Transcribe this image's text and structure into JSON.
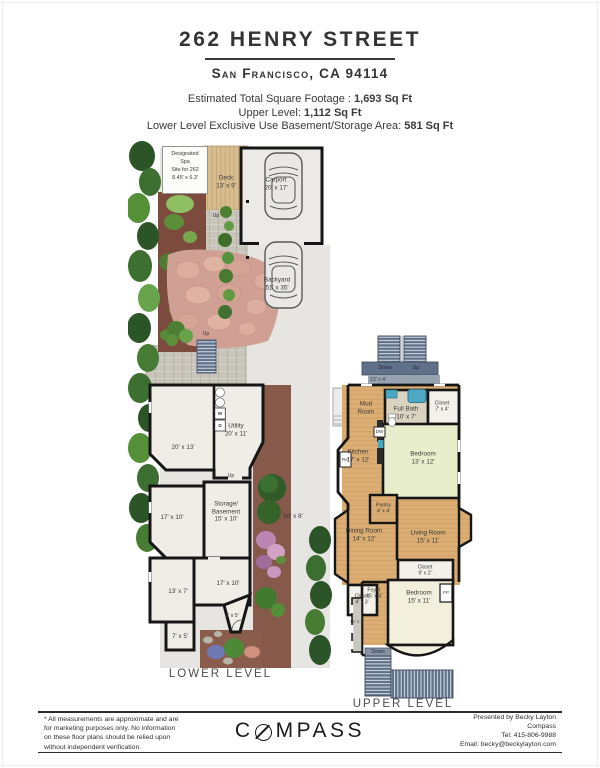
{
  "header": {
    "title": "262 HENRY STREET",
    "subtitle": "San Francisco, CA 94114",
    "sqft_lines": [
      {
        "label": "Estimated Total Square Footage : ",
        "value": "1,693 Sq Ft"
      },
      {
        "label": "Upper Level: ",
        "value": "1,112 Sq Ft"
      },
      {
        "label": "Lower Level Exclusive Use Basement/Storage Area: ",
        "value": "581 Sq Ft"
      }
    ]
  },
  "lower_level": {
    "caption": "LOWER LEVEL",
    "labels": {
      "spa": "Designated\nSpa\nSite for 262\n8.45' x 6.3'",
      "deck": "Deck\n13' x 9'",
      "up_path": "Up",
      "carport": "Carport\n20' x 17'",
      "backyard": "Backyard\n51' x 35'",
      "up_stairs": "Up",
      "room_20x13": "20' x 13'",
      "utility": "Utility\n20' x 11'",
      "washer": "W",
      "dryer": "D",
      "up_interior": "Up",
      "room_17x10_left": "17' x 10'",
      "storage": "Storage/\nBasement\n15' x 10'",
      "side_yard": "58' x 8'",
      "room_17x10_mid": "17' x 10'",
      "room_13x7": "13' x 7'",
      "room_6x5": "6' x 5'",
      "room_7x5": "7' x 5'"
    }
  },
  "upper_level": {
    "caption": "UPPER LEVEL",
    "labels": {
      "stairs_down": "Down",
      "stairs_up": "Up",
      "landing": "13' x 4'",
      "mud_room": "Mud\nRoom",
      "full_bath": "Full Bath\n10' x 7'",
      "closet_bath": "Closet\n7' x 4'",
      "bedroom_rear": "Bedroom\n13' x 12'",
      "kitchen": "Kitchen\n17' x 12'",
      "dishwasher": "DW",
      "refrigerator": "Ref",
      "pantry": "Pantry\n4' x 4'",
      "living_room": "Living Room\n15' x 11'",
      "dining_room": "Dining Room\n14' x 12'",
      "closet_hall": "Closet\n9' x 2'",
      "closet_foyer": "Closet\n4' x 3'",
      "foyer": "Foyer\n15' x 4'",
      "bedroom_front": "Bedroom\n15' x 11'",
      "fireplace": "FP",
      "hall": "11' x 3'",
      "stairs_bottom": "Down"
    }
  },
  "footer": {
    "disclaimer": "* All measurements are approximate and are\nfor marketing purposes only. No information\non these floor plans should be relied upon\nwithout independent verification.",
    "logo": {
      "left": "C",
      "right": "MPASS"
    },
    "presented": [
      "Presented by Becky Layton",
      "Compass",
      "Tel: 415-806-9988",
      "Email: becky@beckylayton.com"
    ]
  }
}
